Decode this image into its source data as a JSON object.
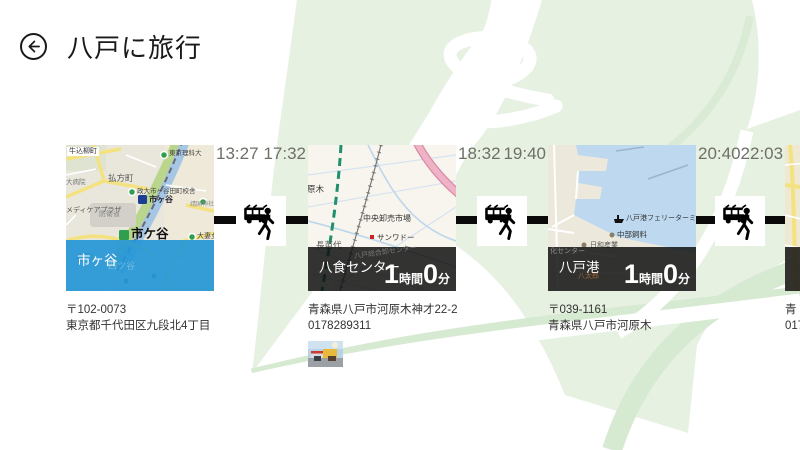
{
  "header": {
    "title": "八戸に旅行"
  },
  "timeline": {
    "legs": [
      {
        "depart": "13:27",
        "arrive": "17:32"
      },
      {
        "depart": "18:32",
        "arrive": "19:40"
      },
      {
        "depart": "20:40",
        "arrive": "22:03"
      }
    ],
    "stops": [
      {
        "name": "市ヶ谷",
        "line1": "〒102-0073",
        "line2": "東京都千代田区九段北4丁目"
      },
      {
        "name": "八食センター",
        "duration": {
          "h": "1",
          "h_unit": "時間",
          "m": "0",
          "m_unit": "分"
        },
        "line1": "青森県八戸市河原木神才22-2",
        "line2": "0178289311"
      },
      {
        "name": "八戸港",
        "duration": {
          "h": "1",
          "h_unit": "時間",
          "m": "0",
          "m_unit": "分"
        },
        "line1": "〒039-1161",
        "line2": "青森県八戸市河原木"
      },
      {
        "name": "",
        "line1": "青",
        "line2": "017"
      }
    ]
  },
  "maps": {
    "ichigaya": {
      "labels": [
        "牛込柳町",
        "大病院",
        "払方町",
        "東京理科大",
        "政大市ヶ谷田町校舎",
        "メディケアプラザ",
        "防衛省",
        "市ヶ谷",
        "市ケ谷",
        "大妻女",
        "坂町",
        "靖国神社",
        "四ツ谷"
      ]
    },
    "hasshoku": {
      "labels": [
        "原木",
        "中央卸売市場",
        "サンワドー",
        "長苗代",
        "八戸総合卸センター"
      ]
    },
    "port": {
      "labels": [
        "八戸港フェリーターミナル",
        "中部飼料",
        "日和産業",
        "化センター",
        "八太郎"
      ]
    }
  },
  "colors": {
    "accent_blue": "#2496d6",
    "connector_black": "#0a0a0a",
    "background_green": "#e7f1e2",
    "time_text_gray": "#6f6f68"
  }
}
